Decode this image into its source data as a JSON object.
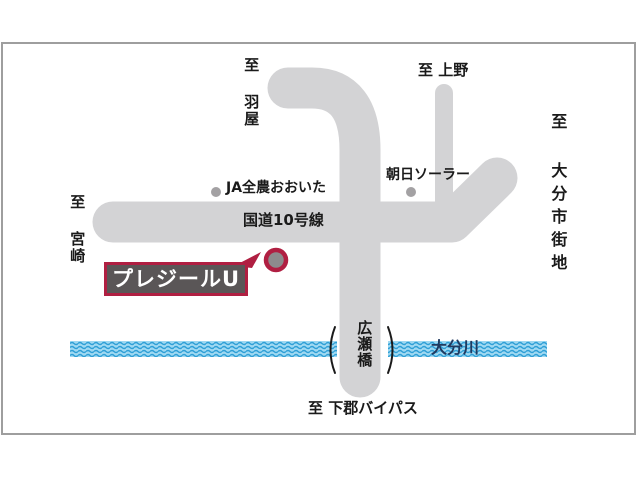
{
  "labels": {
    "dealer": "プレジールU",
    "route": "国道10号線",
    "river": "大分川",
    "bridge": "広瀬橋"
  },
  "destinations": {
    "haneya": "至 羽屋",
    "ueno": "至 上野",
    "oita_city": "至 大分市街地",
    "miyazaki": "至 宮崎",
    "shimogori_bypass": "至 下郡バイパス"
  },
  "pois": {
    "ja_zennoh_oita": "JA全農おおいた",
    "asahi_solar": "朝日ソーラー"
  },
  "colors": {
    "road": "#d3d3d5",
    "frame_border": "#9e9e9e",
    "river_base": "#9fd9f2",
    "river_wave": "#2e9fd6",
    "river_text": "#203a60",
    "accent_red": "#b01f42",
    "dealer_box_bg": "#5a5657",
    "dealer_box_text": "#ffffff",
    "poi_dot": "#a3a1a3",
    "marker_fill": "#8d8b8d",
    "text": "#1a1a1a"
  }
}
